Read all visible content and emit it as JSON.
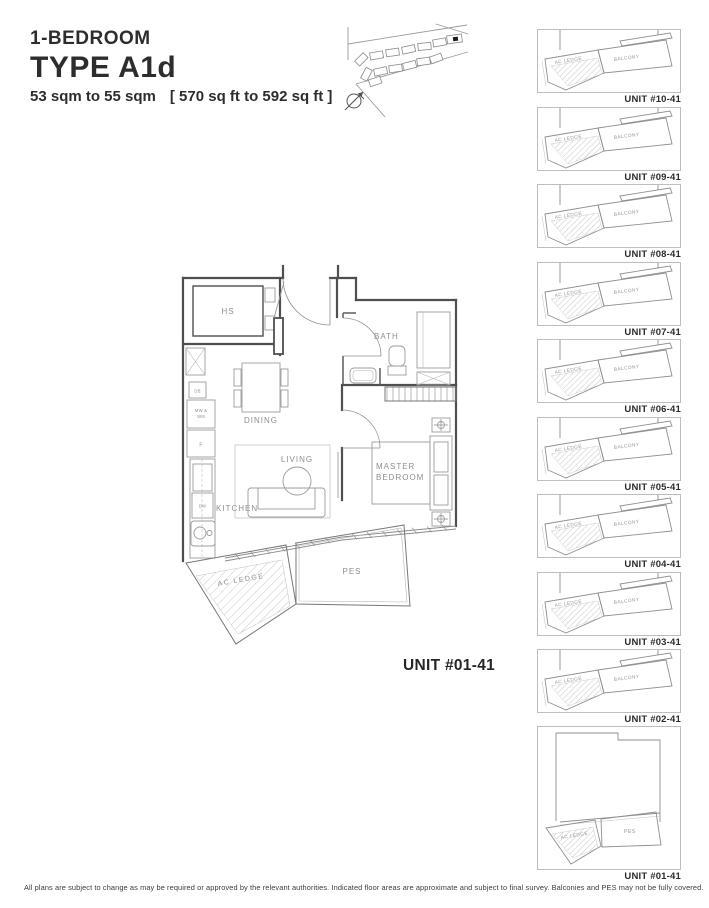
{
  "header": {
    "kicker": "1-BEDROOM",
    "title": "TYPE A1d",
    "area_sqm": "53 sqm to 55 sqm",
    "area_sqft": "[ 570 sq ft to 592 sq ft ]"
  },
  "main_plan": {
    "unit_label": "UNIT #01-41",
    "rooms": {
      "hs": "HS",
      "bath": "BATH",
      "dining": "DINING",
      "living": "LIVING",
      "kitchen": "KITCHEN",
      "master_line1": "MASTER",
      "master_line2": "BEDROOM",
      "ac_ledge": "AC  LEDGE",
      "pes": "PES"
    },
    "appliances": {
      "db": "DB",
      "mw_line1": "MW &",
      "mw_line2": "WM",
      "f": "F",
      "dw": "DW"
    }
  },
  "unit_stack": {
    "items": [
      {
        "label": "UNIT #10-41",
        "ac_ledge": "AC LEDGE",
        "balcony": "BALCONY"
      },
      {
        "label": "UNIT #09-41",
        "ac_ledge": "AC LEDGE",
        "balcony": "BALCONY"
      },
      {
        "label": "UNIT #08-41",
        "ac_ledge": "AC LEDGE",
        "balcony": "BALCONY"
      },
      {
        "label": "UNIT #07-41",
        "ac_ledge": "AC LEDGE",
        "balcony": "BALCONY"
      },
      {
        "label": "UNIT #06-41",
        "ac_ledge": "AC LEDGE",
        "balcony": "BALCONY"
      },
      {
        "label": "UNIT #05-41",
        "ac_ledge": "AC LEDGE",
        "balcony": "BALCONY"
      },
      {
        "label": "UNIT #04-41",
        "ac_ledge": "AC LEDGE",
        "balcony": "BALCONY"
      },
      {
        "label": "UNIT #03-41",
        "ac_ledge": "AC LEDGE",
        "balcony": "BALCONY"
      },
      {
        "label": "UNIT #02-41",
        "ac_ledge": "AC LEDGE",
        "balcony": "BALCONY"
      },
      {
        "label": "UNIT #01-41",
        "ac_ledge": "AC LEDGE",
        "pes": "PES"
      }
    ]
  },
  "footer": {
    "disclaimer": "All plans are subject to change as may be required or approved by the relevant authorities. Indicated floor areas are approximate and subject to final survey. Balconies and PES may not be fully covered."
  }
}
